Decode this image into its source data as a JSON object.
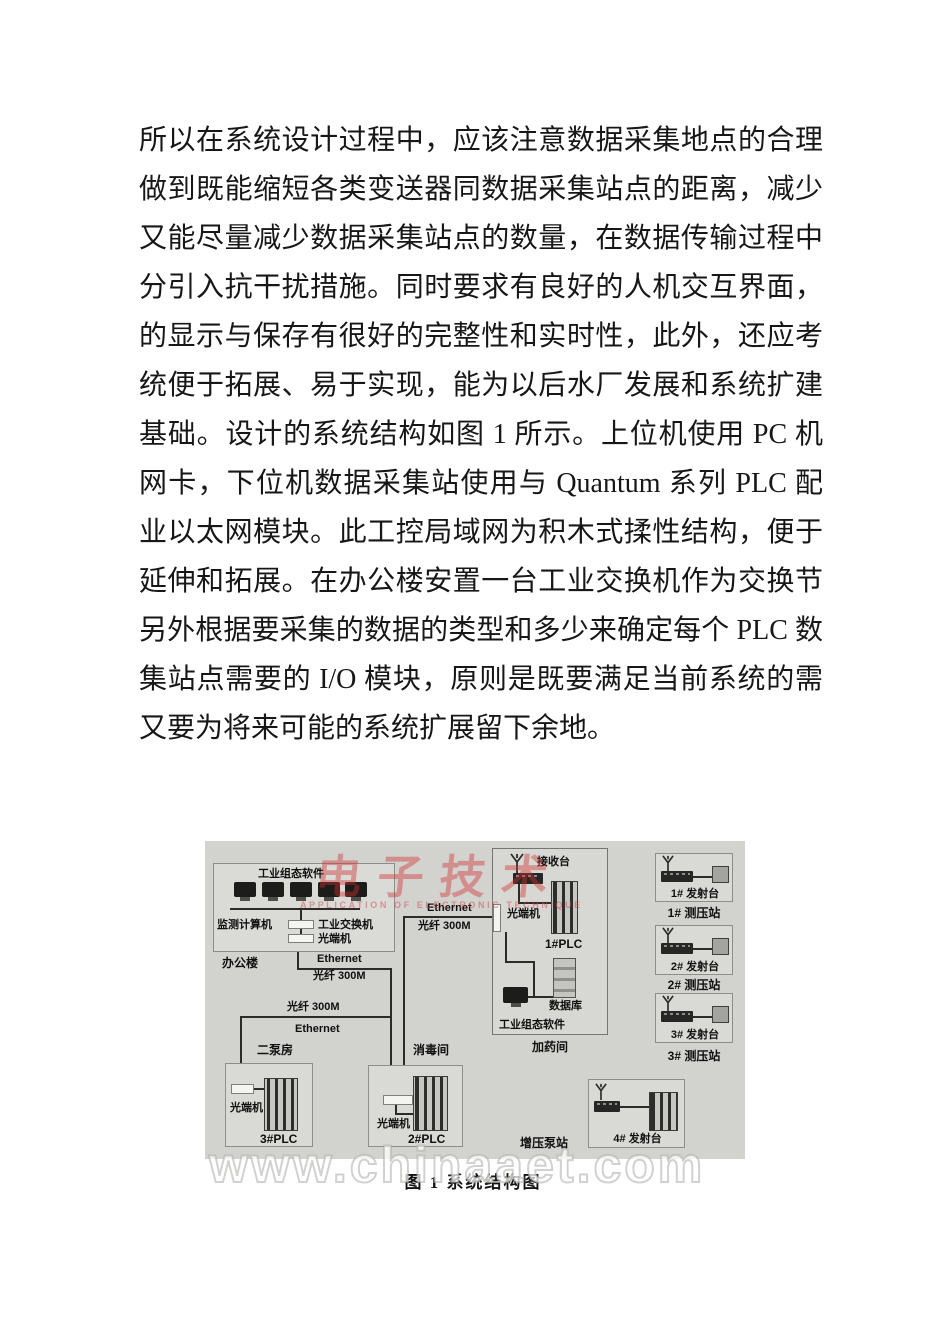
{
  "body": {
    "lines": [
      "所以在系统设计过程中，应该注意数据采集地点的合理选取，",
      "做到既能缩短各类变送器同数据采集站点的距离，减少干扰，",
      "又能尽量减少数据采集站点的数量，在数据传输过程中应充",
      "分引入抗干扰措施。同时要求有良好的人机交互界面，数据",
      "的显示与保存有很好的完整性和实时性，此外，还应考虑系",
      "统便于拓展、易于实现，能为以后水厂发展和系统扩建打好",
      "基础。设计的系统结构如图 1 所示。上位机使用 PC 机自带的",
      "网卡，下位机数据采集站使用与 Quantum 系列 PLC 配套的工",
      "业以太网模块。此工控局域网为积木式揉性结构，便于网络",
      "延伸和拓展。在办公楼安置一台工业交换机作为交换节点。",
      "另外根据要采集的数据的类型和多少来确定每个 PLC 数据采",
      "集站点需要的 I/O 模块，原则是既要满足当前系统的需要，",
      "又要为将来可能的系统扩展留下余地。"
    ]
  },
  "diagram": {
    "links": {
      "ethernet": "Ethernet",
      "fiber": "光纤 300M"
    },
    "office": {
      "software": "工业组态软件",
      "computers": "监测计算机",
      "switch": "工业交换机",
      "modem": "光端机",
      "building": "办公楼"
    },
    "dosing": {
      "receiver": "接收台",
      "modem": "光端机",
      "plc": "1#PLC",
      "database": "数据库",
      "software": "工业组态软件",
      "room": "加药间"
    },
    "pump2": {
      "room": "二泵房",
      "modem": "光端机",
      "plc": "3#PLC"
    },
    "disinfect": {
      "room": "消毒间",
      "modem": "光端机",
      "plc": "2#PLC"
    },
    "booster": {
      "room": "增压泵站",
      "transmitter": "4# 发射台"
    },
    "stations": [
      {
        "transmitter": "1# 发射台",
        "station": "1# 测压站"
      },
      {
        "transmitter": "2# 发射台",
        "station": "2# 测压站"
      },
      {
        "transmitter": "3# 发射台",
        "station": "3# 测压站"
      }
    ],
    "caption": "图 1 系统结构图"
  },
  "watermarks": {
    "logo": "电子技术",
    "logo_sub": "APPLICATION OF ELECTRONIC TECHNIQUE",
    "site": "www.chinaaet.com"
  },
  "icons": {
    "antenna": "antenna-icon",
    "monitor": "monitor-icon",
    "transmitter_device": "radio-device-icon",
    "plc_rack": "plc-rack",
    "database_rack": "database-rack",
    "fiber_modem": "fiber-modem-box"
  },
  "colors": {
    "diagram_bg": "#d2d2cf",
    "box_bg": "#d9d9d5",
    "wire": "#2b2b29",
    "logo_red": "#d03030",
    "text": "#171717"
  }
}
